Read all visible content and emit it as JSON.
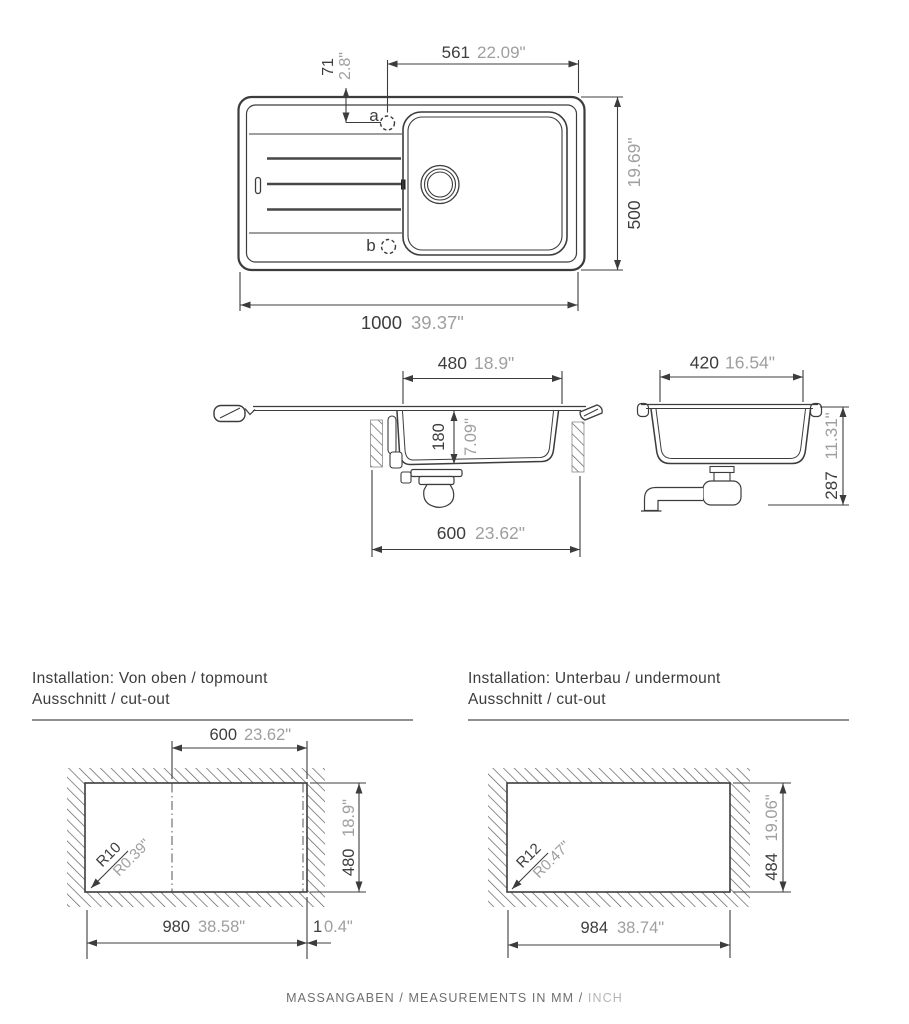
{
  "top_view": {
    "hole_a_label": "a",
    "hole_b_label": "b",
    "dim_hole_offset_mm": "71",
    "dim_hole_offset_in": "2.8\"",
    "dim_hole_right_mm": "561",
    "dim_hole_right_in": "22.09\"",
    "dim_depth_mm": "500",
    "dim_depth_in": "19.69\"",
    "dim_width_mm": "1000",
    "dim_width_in": "39.37\""
  },
  "side_view": {
    "dim_bowl_top_mm": "480",
    "dim_bowl_top_in": "18.9\"",
    "dim_bowl_depth_mm": "180",
    "dim_bowl_depth_in": "7.09\"",
    "dim_bowl_base_mm": "600",
    "dim_bowl_base_in": "23.62\""
  },
  "end_view": {
    "dim_bowl_width_mm": "420",
    "dim_bowl_width_in": "16.54\"",
    "dim_height_mm": "287",
    "dim_height_in": "11.31\""
  },
  "topmount": {
    "title": "Installation: Von oben / topmount",
    "subtitle": "Ausschnitt / cut-out",
    "dim_bowl_mm": "600",
    "dim_bowl_in": "23.62\"",
    "dim_cut_depth_mm": "480",
    "dim_cut_depth_in": "18.9\"",
    "dim_cut_width_mm": "980",
    "dim_cut_width_in": "38.58\"",
    "dim_edge_mm": "1",
    "dim_edge_in": "0.4\"",
    "radius_mm": "R10",
    "radius_in": "R0.39\""
  },
  "undermount": {
    "title": "Installation: Unterbau / undermount",
    "subtitle": "Ausschnitt / cut-out",
    "dim_cut_width_mm": "984",
    "dim_cut_width_in": "38.74\"",
    "dim_cut_depth_mm": "484",
    "dim_cut_depth_in": "19.06\"",
    "radius_mm": "R12",
    "radius_in": "R0.47\""
  },
  "footer": {
    "mm_part": "MASSANGABEN / MEASUREMENTS IN MM /",
    "inch_part": "INCH"
  }
}
